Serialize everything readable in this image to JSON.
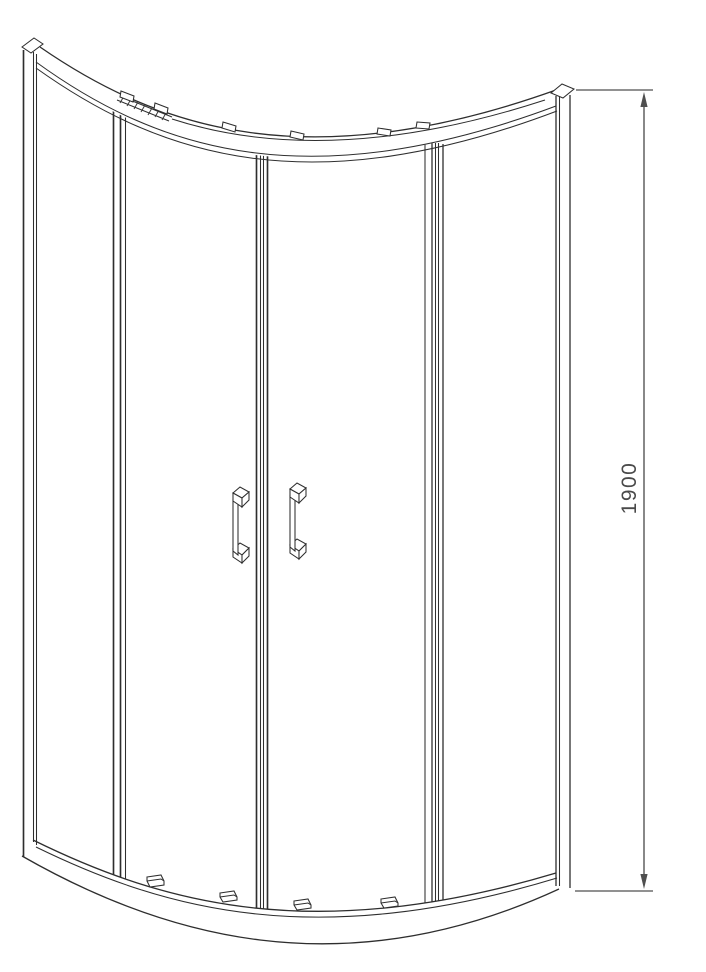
{
  "drawing": {
    "title": "quadrant-shower-enclosure-front-elevation",
    "dimension": {
      "label": "1900"
    },
    "colors": {
      "line": "#2e2e2e",
      "dimension": "#4f4f4f",
      "background": "#ffffff"
    }
  }
}
